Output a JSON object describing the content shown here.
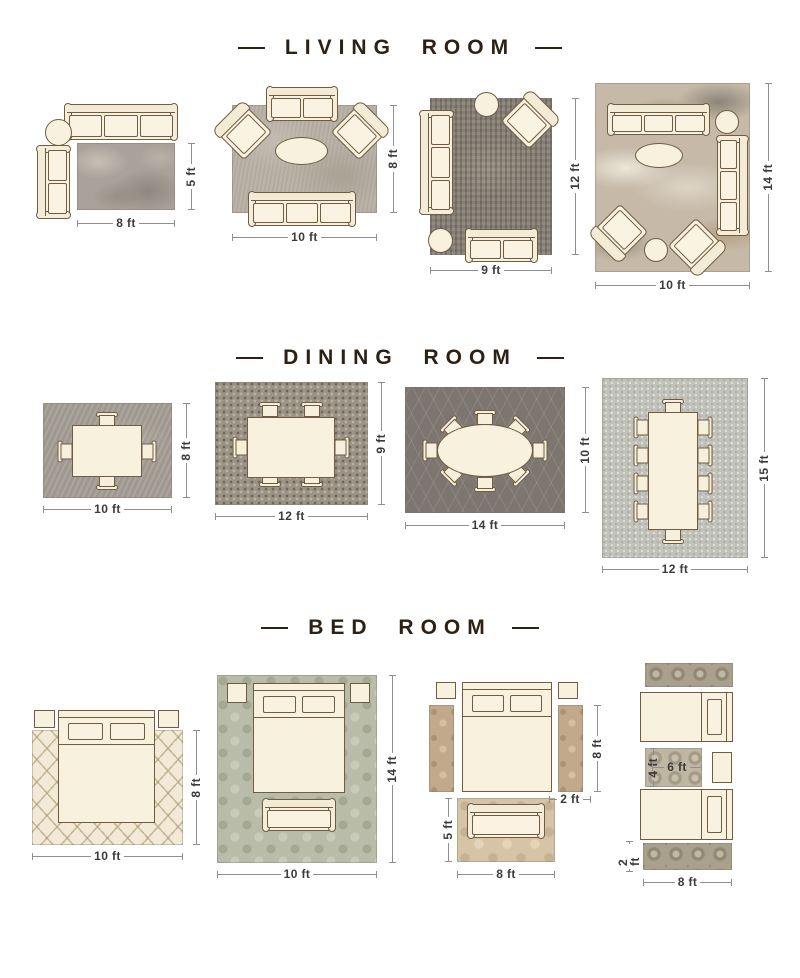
{
  "colors": {
    "title": "#2d2115",
    "label": "#3b3b3b",
    "line": "#8f8f8f",
    "furn": "#f8f1de",
    "outline": "#6f5c41"
  },
  "sections": [
    {
      "id": "living-room",
      "title": "LIVING ROOM",
      "layouts": [
        {
          "width": "8 ft",
          "height": "5 ft"
        },
        {
          "width": "10 ft",
          "height": "8 ft"
        },
        {
          "width": "9 ft",
          "height": "12 ft"
        },
        {
          "width": "10 ft",
          "height": "14 ft"
        }
      ]
    },
    {
      "id": "dining-room",
      "title": "DINING ROOM",
      "layouts": [
        {
          "width": "10 ft",
          "height": "8 ft"
        },
        {
          "width": "12 ft",
          "height": "9 ft"
        },
        {
          "width": "14 ft",
          "height": "10 ft"
        },
        {
          "width": "12 ft",
          "height": "15 ft"
        }
      ]
    },
    {
      "id": "bed-room",
      "title": "BED ROOM",
      "layouts": [
        {
          "width": "10 ft",
          "height": "8 ft"
        },
        {
          "width": "10 ft",
          "height": "14 ft"
        },
        {
          "bed_rug_height": "8 ft",
          "runner_width": "2 ft",
          "bench_rug_width": "8 ft",
          "bench_rug_height": "5 ft"
        },
        {
          "accent_rug_width": "6 ft",
          "accent_rug_height": "4 ft",
          "runner_height": "2 ft",
          "runner_width": "8 ft"
        }
      ]
    }
  ]
}
